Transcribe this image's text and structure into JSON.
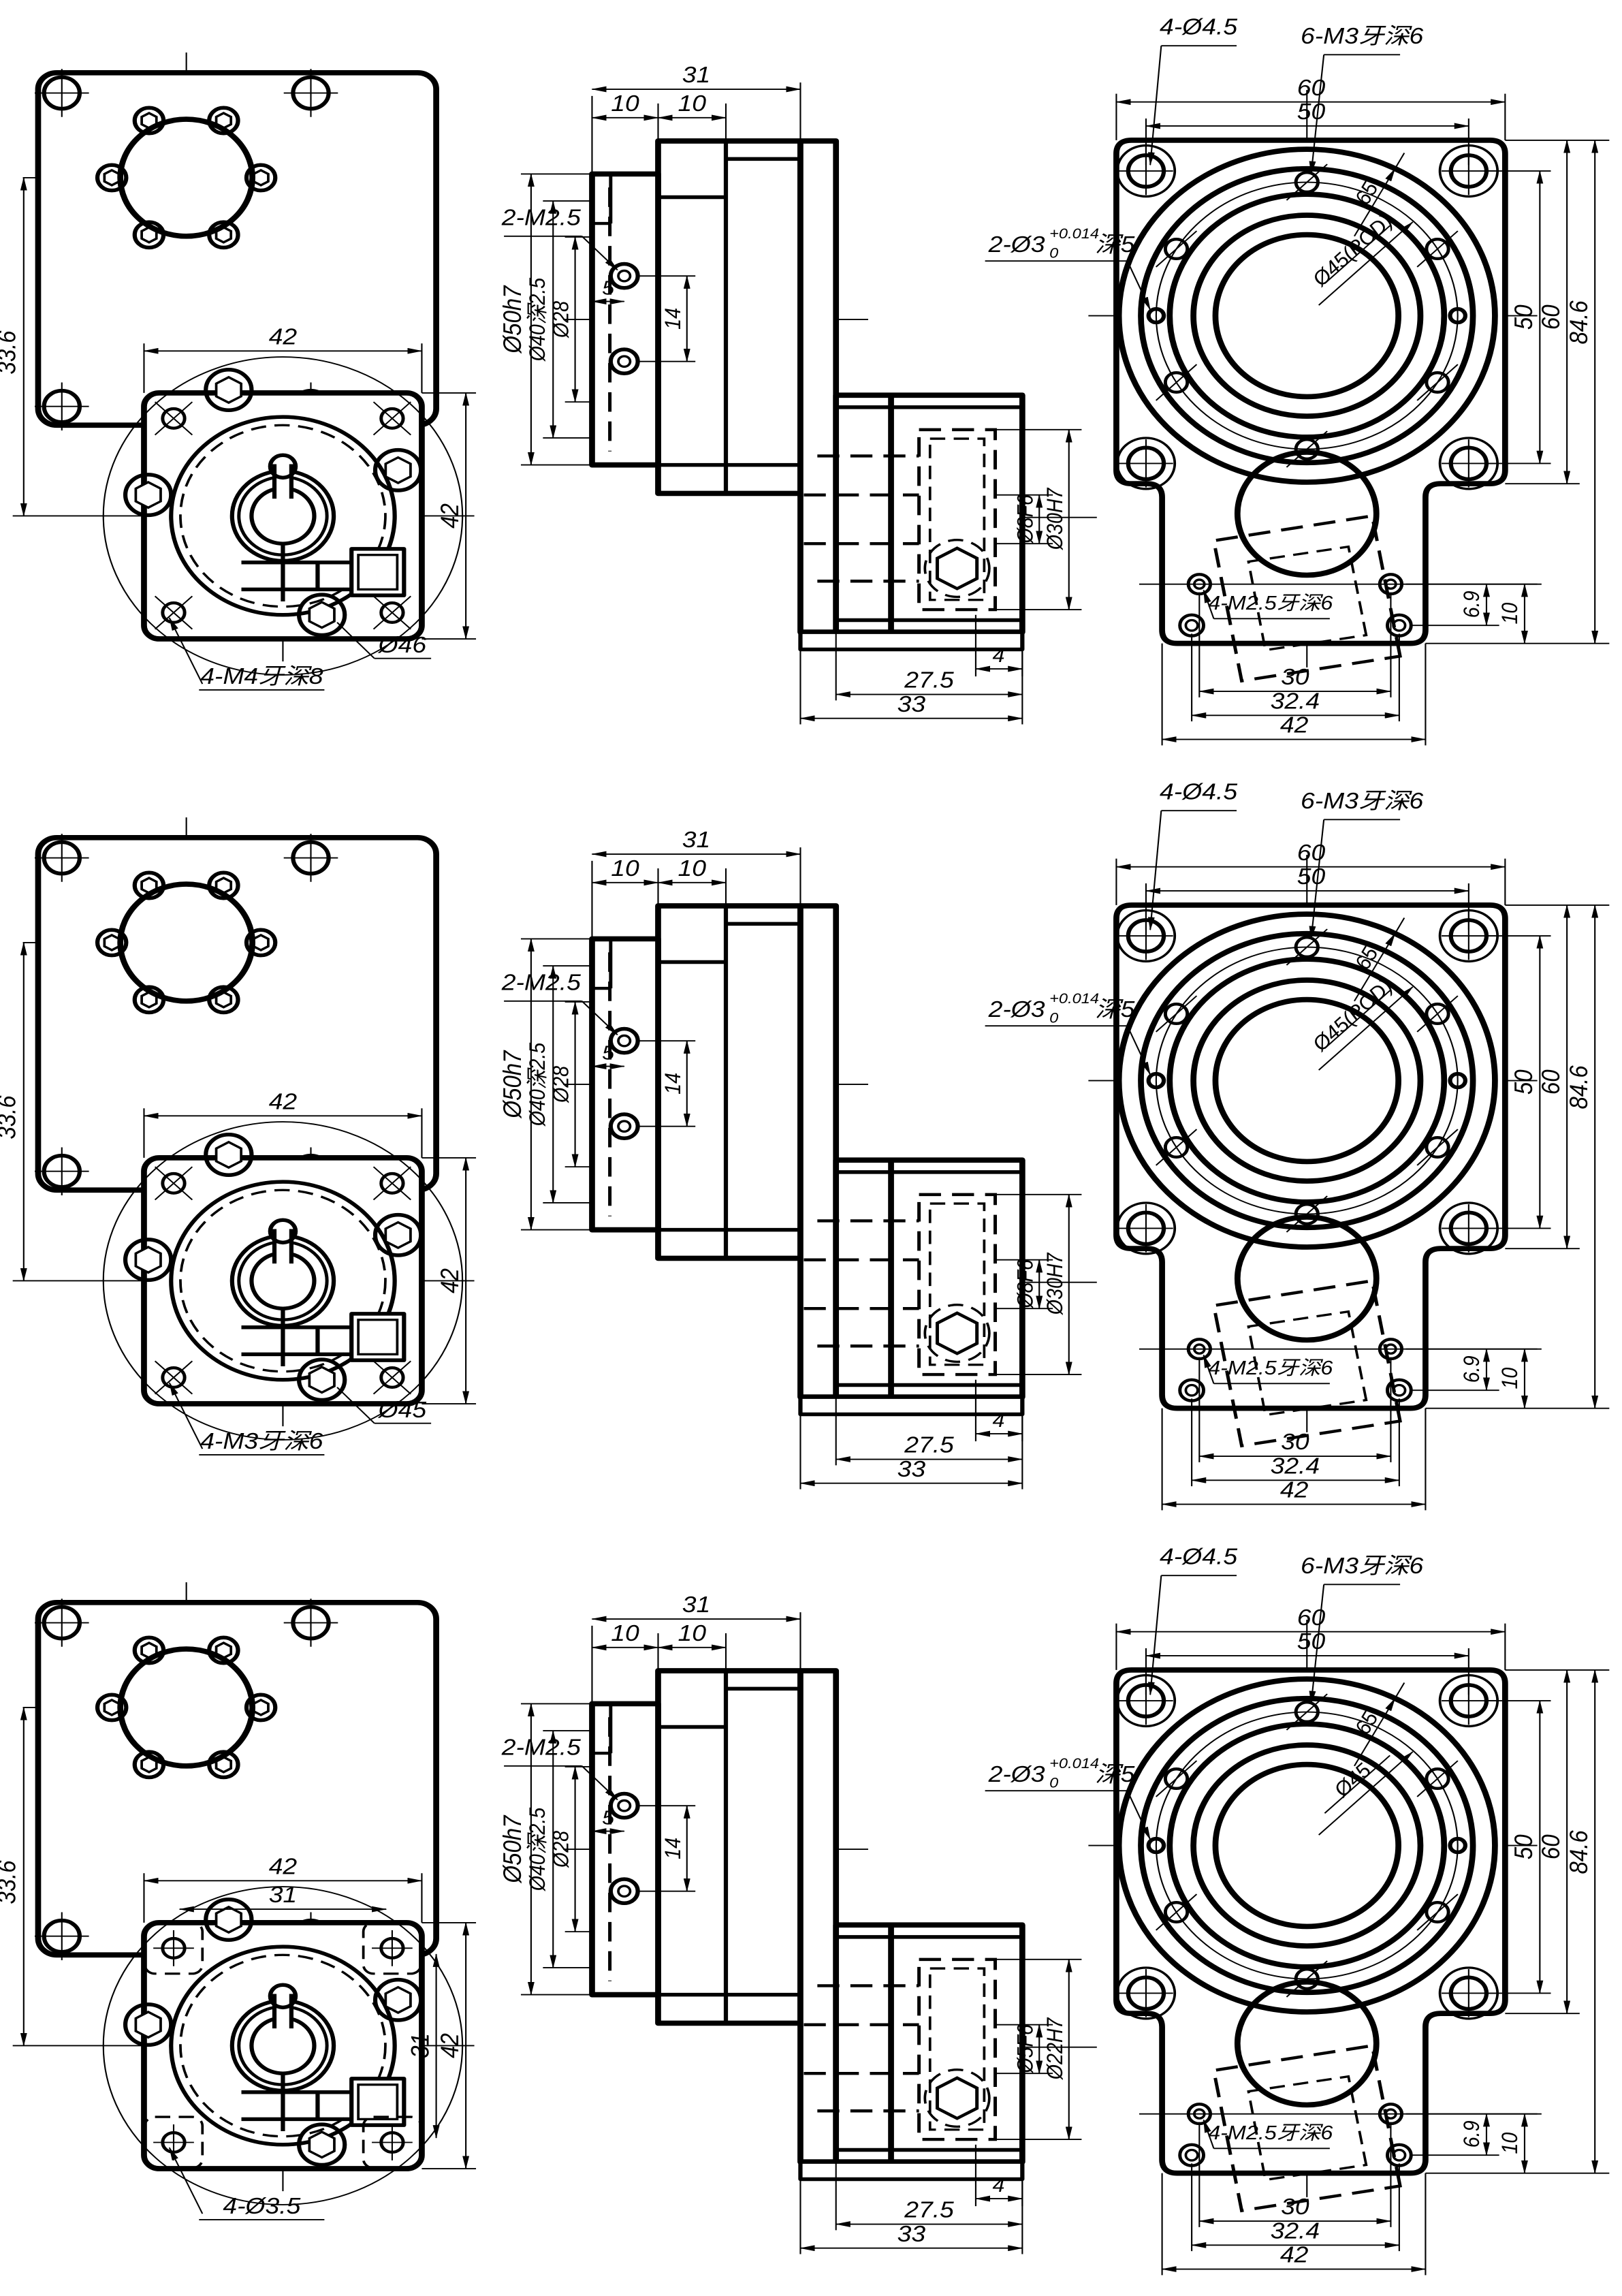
{
  "document": {
    "type": "engineering-drawing",
    "sheet_color": "#ffffff",
    "line_color": "#000000",
    "rows_count": 3
  },
  "common": {
    "left_view": {
      "dim_center_offset": "33.6",
      "dim_flange_width": "42",
      "dim_flange_height": "42"
    },
    "middle_view": {
      "dim_total_depth": "31",
      "dim_step1": "10",
      "dim_step2": "10",
      "note_screws": "2-M2.5",
      "dia_spigot": "Ø50h7",
      "dia_recess": "Ø40深2.5",
      "dia_inner": "Ø28",
      "dim_screw_offset": "5",
      "dim_screw_spacing": "14",
      "dim_boss_len": "4",
      "dim_body_len": "27.5",
      "dim_overall_len": "33"
    },
    "right_view": {
      "note_corner_holes": "4-Ø4.5",
      "note_tapped_holes": "6-M3牙深6",
      "dim_width_outer": "60",
      "dim_hole_spacing_top": "50",
      "dim_boss_dia": "65",
      "note_pin_prefix": "2-Ø3",
      "note_pin_tol_upper": "+0.014",
      "note_pin_tol_lower": "0",
      "note_pin_depth": "深5",
      "dim_hole_spacing_right": "50",
      "dim_height_square": "60",
      "dim_height_total": "84.6",
      "dim_hole_row_gap": "6.9",
      "dim_hole_row_edge": "10",
      "note_tab_screws": "4-M2.5牙深6",
      "dim_tab_holes_1": "30",
      "dim_tab_holes_2": "32.4",
      "dim_tab_width": "42"
    }
  },
  "rows": [
    {
      "left_hole_note": "4-M4牙深8",
      "left_boss_dia": "Ø46",
      "bore_small": "Ø8F6",
      "bore_large": "Ø30H7",
      "pcd_label": "Ø45(PCD)",
      "extra_dim_w": "",
      "extra_dim_h": ""
    },
    {
      "left_hole_note": "4-M3牙深6",
      "left_boss_dia": "Ø45",
      "bore_small": "Ø8F6",
      "bore_large": "Ø30H7",
      "pcd_label": "Ø45(PCD)",
      "extra_dim_w": "",
      "extra_dim_h": ""
    },
    {
      "left_hole_note": "4-Ø3.5",
      "left_boss_dia": "",
      "bore_small": "Ø5F6",
      "bore_large": "Ø22H7",
      "pcd_label": "Ø45",
      "extra_dim_w": "31",
      "extra_dim_h": "31"
    }
  ]
}
